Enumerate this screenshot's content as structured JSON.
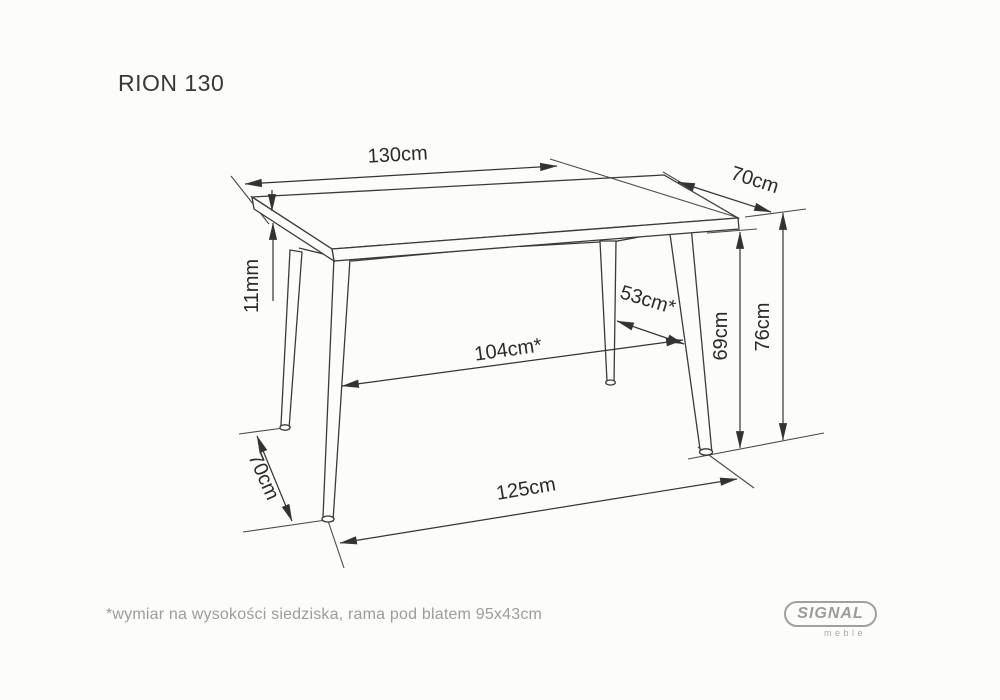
{
  "title": "RION 130",
  "dimensions": {
    "top_length": "130cm",
    "top_depth": "70cm",
    "top_thickness": "11mm",
    "inner_length_at_seat": "104cm*",
    "inner_depth_at_seat": "53cm*",
    "frame_height": "69cm",
    "total_height": "76cm",
    "feet_depth": "70cm",
    "feet_length": "125cm"
  },
  "footnote": "*wymiar na wysokości siedziska, rama pod blatem 95x43cm",
  "brand": {
    "name": "SIGNAL",
    "tagline": "meble"
  },
  "colors": {
    "line": "#3a3a3a",
    "muted": "#9b9b9b",
    "background": "#fcfcfa"
  }
}
